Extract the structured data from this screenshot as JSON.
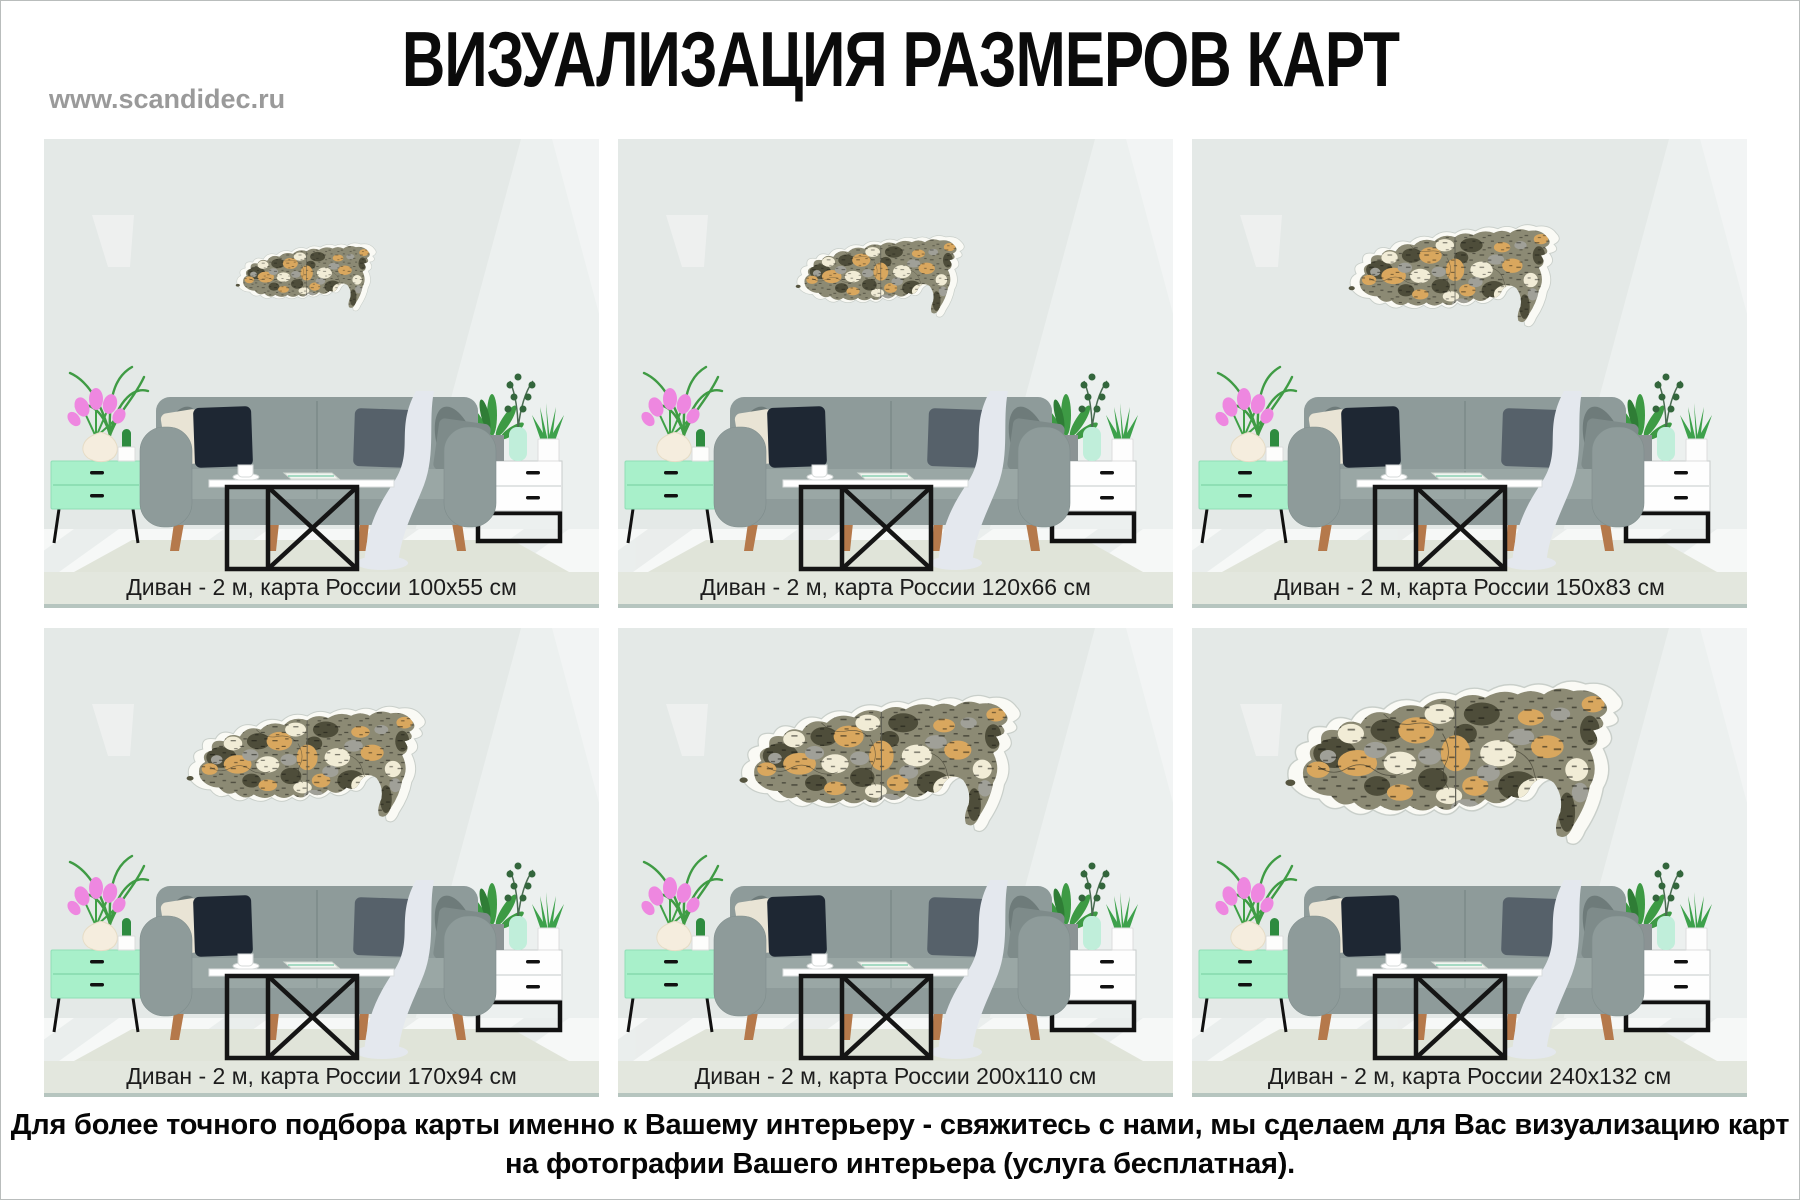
{
  "header": {
    "site_url": "www.scandidec.ru",
    "title": "ВИЗУАЛИЗАЦИЯ РАЗМЕРОВ КАРТ"
  },
  "panels": [
    {
      "caption": "Диван - 2 м, карта России 100x55 см",
      "sofa_width_m": 2,
      "map_width_cm": 100,
      "map_height_cm": 55
    },
    {
      "caption": "Диван - 2 м, карта России 120x66 см",
      "sofa_width_m": 2,
      "map_width_cm": 120,
      "map_height_cm": 66
    },
    {
      "caption": "Диван - 2 м, карта России 150x83 см",
      "sofa_width_m": 2,
      "map_width_cm": 150,
      "map_height_cm": 83
    },
    {
      "caption": "Диван - 2 м, карта России 170x94 см",
      "sofa_width_m": 2,
      "map_width_cm": 170,
      "map_height_cm": 94
    },
    {
      "caption": "Диван - 2 м, карта России 200x110 см",
      "sofa_width_m": 2,
      "map_width_cm": 200,
      "map_height_cm": 110
    },
    {
      "caption": "Диван - 2 м, карта России 240x132 см",
      "sofa_width_m": 2,
      "map_width_cm": 240,
      "map_height_cm": 132
    }
  ],
  "footer": {
    "line1": "Для более точного подбора карты именно к Вашему интерьеру - свяжитесь с нами, мы сделаем для Вас визуализацию карт",
    "line2": "на фотографии Вашего интерьера (услуга бесплатная)."
  },
  "colors": {
    "wall": "#e4e9e7",
    "caption_band": "#e3e7de",
    "caption_rule": "#b6c5bf",
    "rug": "#e0e4d9",
    "sofa": "#8e9b9a",
    "sofa_seat": "#9aa7a5",
    "pillow_navy": "#1e2733",
    "pillow_cream": "#e9e4d5",
    "blanket": "#e4e8ee",
    "cabinet_mint": "#a8f0ca",
    "dresser_white": "#fefefe",
    "wood_leg": "#b5794b",
    "flower_pink": "#ee87e0",
    "plant_green": "#3f9b44",
    "map_tan": "#d9a75e",
    "map_dark_olive": "#4e4d3a",
    "map_cream": "#f1ecd6",
    "map_gray": "#a0a098",
    "map_backing": "#fafaf5",
    "title_text": "#0b0b0b",
    "site_url_text": "#9a9a9a"
  }
}
